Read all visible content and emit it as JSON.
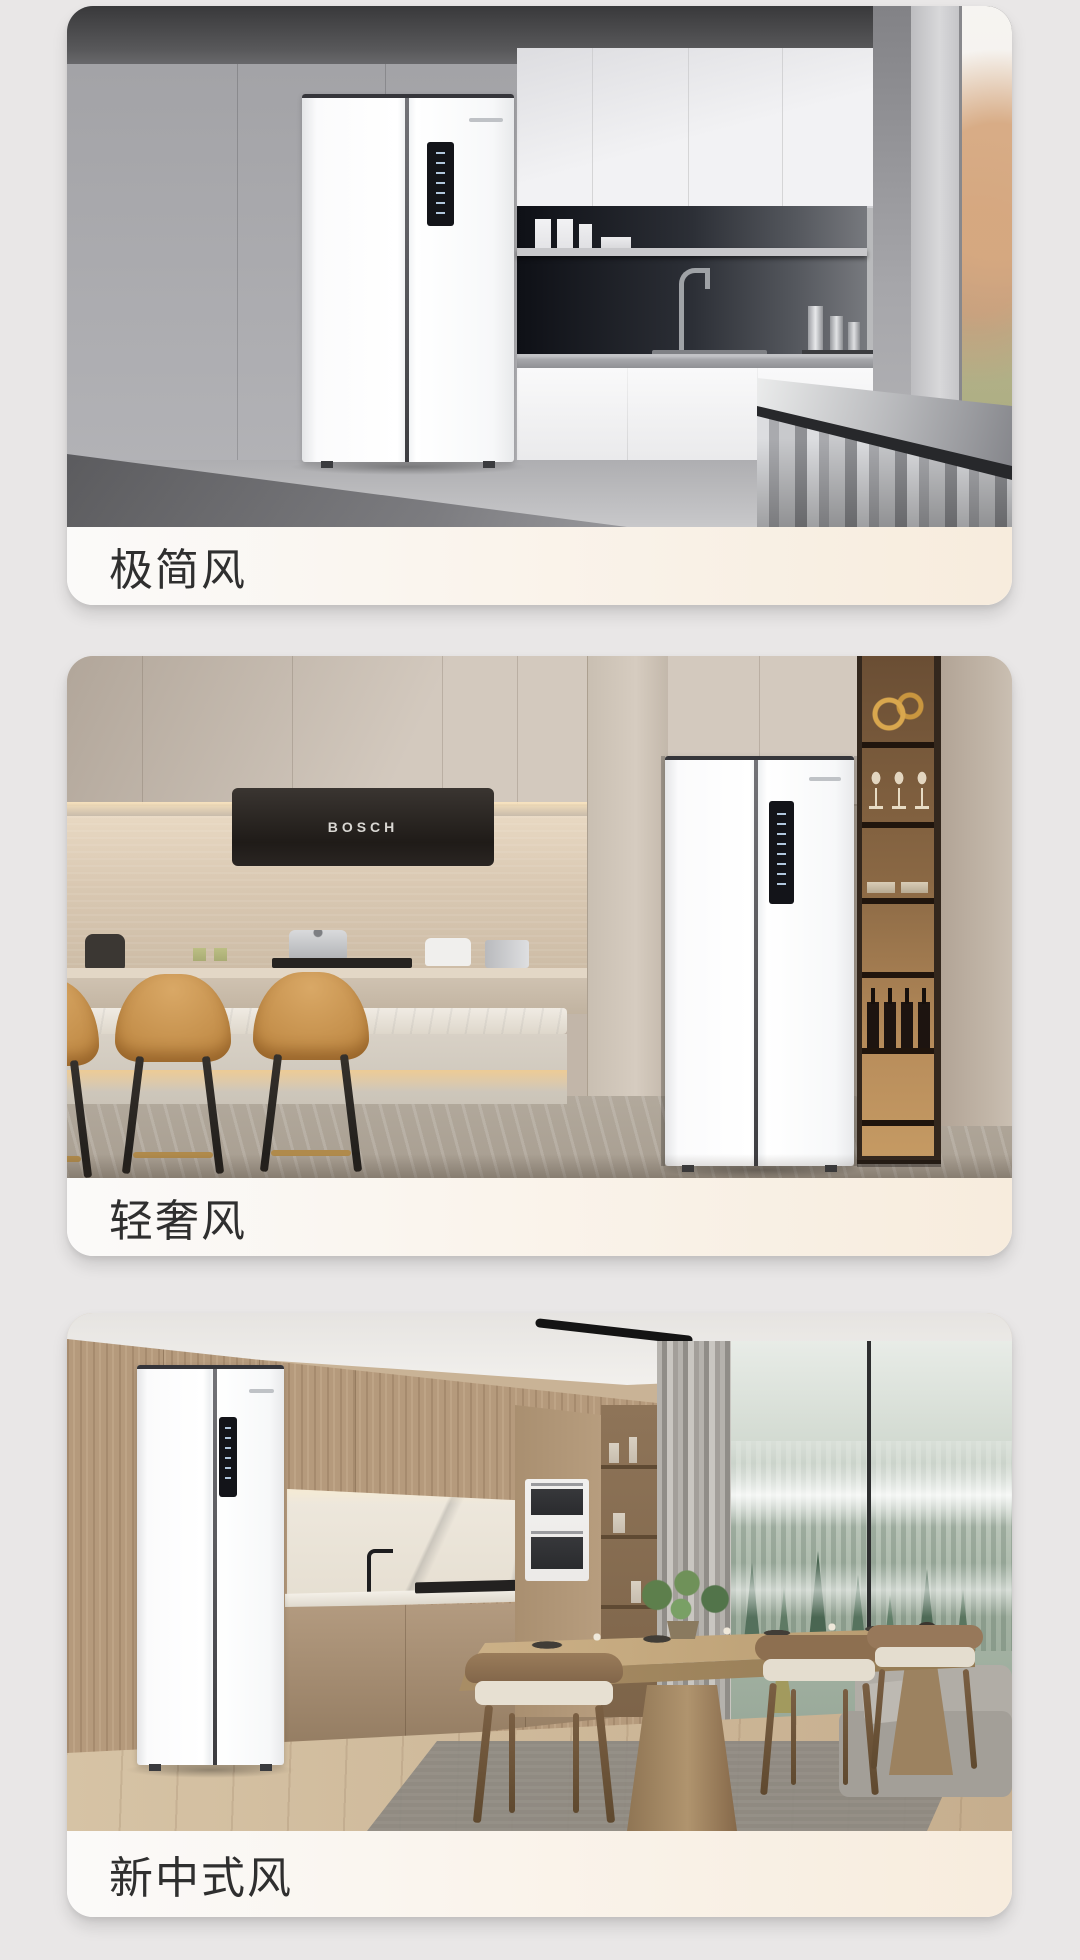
{
  "page": {
    "background": "#e9e7e7",
    "description_note": ""
  },
  "colors": {
    "page_bg": "#e9e7e7",
    "label_bar_left": "#fbfaf9",
    "label_bar_right": "#f7ecdd",
    "label_text": "#2f2f2f",
    "stool_caramel": "#c08a45",
    "shelf_glow": "#c59a63"
  },
  "cards": [
    {
      "name": "minimalist-style-card",
      "label": "极简风"
    },
    {
      "name": "light-luxury-style-card",
      "label": "轻奢风",
      "hood_brand": "BOSCH"
    },
    {
      "name": "new-chinese-style-card",
      "label": "新中式风"
    }
  ]
}
